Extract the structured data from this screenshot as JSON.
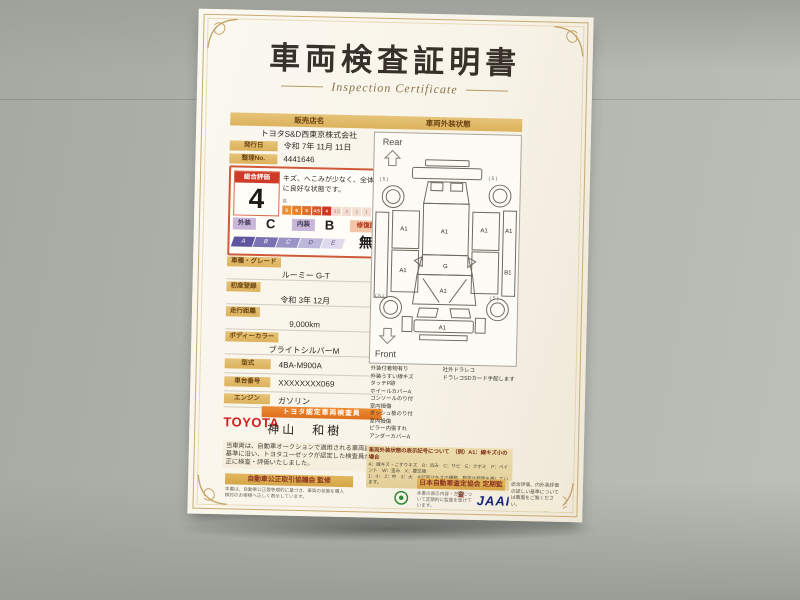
{
  "title": {
    "jp": "車両検査証明書",
    "en": "Inspection Certificate"
  },
  "seller": {
    "header": "販売店名",
    "name": "トヨタS&D西東京株式会社",
    "issue_label": "発行日",
    "issue_value": "令和 7年 11月 11日",
    "no_label": "整理No.",
    "no_value": "4441646"
  },
  "evaluation": {
    "label": "総合評価",
    "score": "4",
    "comment": "キズ、へこみが少なく、全体的に良好な状態です。",
    "scale_high": "高",
    "scale_low": "低",
    "scale_values": [
      "S",
      "6",
      "5",
      "4.5",
      "4",
      "3.5",
      "3",
      "2",
      "1",
      "R/W"
    ],
    "exterior_label": "外装",
    "exterior_grade": "C",
    "interior_label": "内装",
    "interior_grade": "B",
    "repair_label": "修復歴",
    "repair_value": "無",
    "grade_scale": [
      "A",
      "B",
      "C",
      "D",
      "E"
    ]
  },
  "fields": [
    {
      "label": "車種・グレード",
      "value": "ルーミー G-T"
    },
    {
      "label": "初度登録",
      "value": "令和 3年 12月"
    },
    {
      "label": "走行距離",
      "value": "9,000km"
    },
    {
      "label": "ボディーカラー",
      "value": "ブライトシルバーM"
    },
    {
      "label": "型式",
      "value": "4BA-M900A"
    },
    {
      "label": "車台番号",
      "value": "XXXXXXXX069"
    },
    {
      "label": "エンジン",
      "value": "ガソリン"
    }
  ],
  "inspector": {
    "brand": "TOYOTA",
    "banner": "トヨタ認定車両検査員",
    "name": "神山　和樹"
  },
  "disclaimer": "当車両は、自動車オークションで適用される車両評価基準に沿い、トヨタユーゼックが認定した検査員が適正に検査・評価いたしました。",
  "exterior": {
    "header": "車両外装状態",
    "rear_label": "Rear",
    "front_label": "Front",
    "marks": {
      "a1": "A1",
      "b1": "B1",
      "g": "G",
      "tire": "( 5 )"
    },
    "checklist_left": [
      "外装付着物有り",
      "外装うすい線キズ",
      "タッチP跡",
      "ホイールカバーA",
      "コンソールのり付",
      "室内損傷",
      "ダッシュ板のり付",
      "室内損傷",
      "ピラー内張すれ",
      "アンダーカバーA"
    ],
    "checklist_right": [
      "社外ドラレコ",
      "ドラレコSDカード手配します"
    ],
    "legend": {
      "title": "車両外装状態の表示記号について　（例）A1：線キズ小の場合",
      "line1": "A：線キズ・こすりキズ　B：凹み　C：サビ　E：クボミ　P：ペイント　W：歪み　X：要交換",
      "line2": "1：小　2：中　3：大　※記号はキズの種類、数字は程度を表しています。"
    }
  },
  "footer": {
    "left_title": "自動車公正取引協議会 監修",
    "left_note": "本書は、自動車公正競争規約に基づき、車両の状態を購入検討のお客様へ正しく表示しています。",
    "right_title": "日本自動車査定協会 定期監査",
    "right_note": "本書の表示内容・方法について定期的に監査を受けています。",
    "jaai": "JAAI",
    "side_note": "総合評価、内外装評価の詳しい基準については裏面をご覧ください。"
  }
}
